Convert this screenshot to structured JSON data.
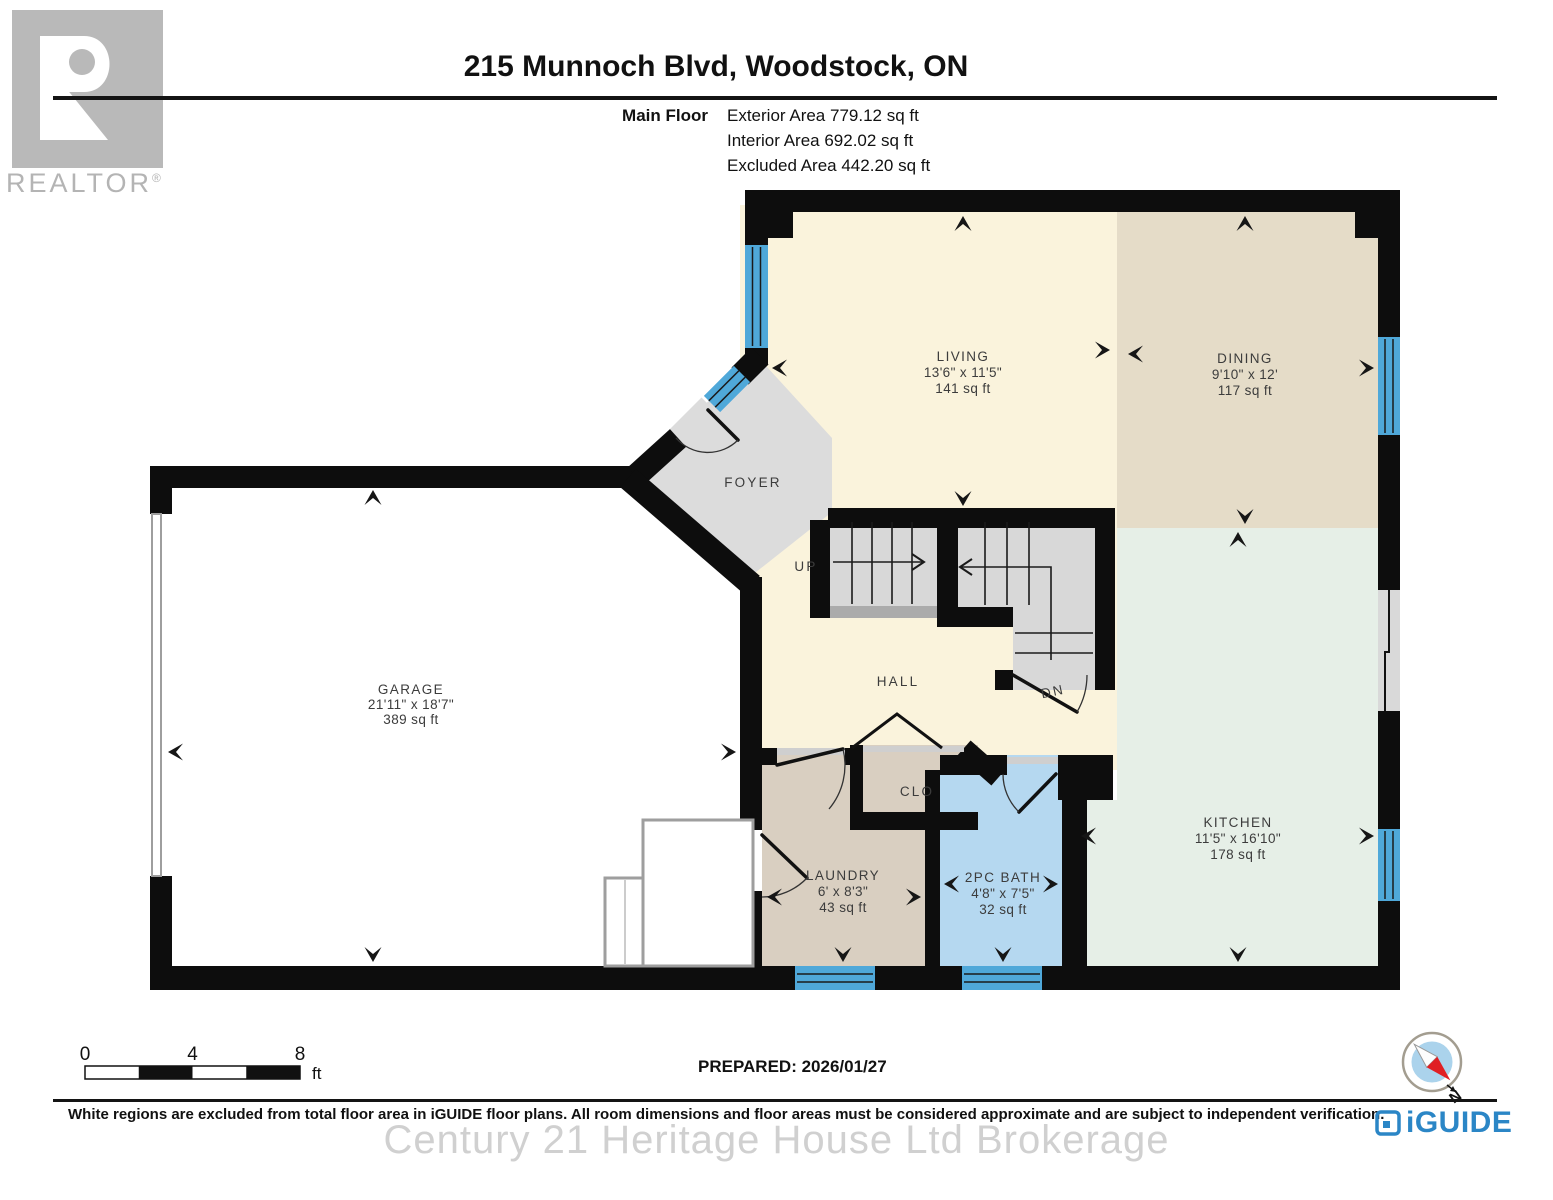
{
  "header": {
    "title": "215 Munnoch Blvd, Woodstock, ON",
    "floor_label": "Main Floor",
    "exterior_area": "Exterior Area 779.12 sq ft",
    "interior_area": "Interior Area 692.02 sq ft",
    "excluded_area": "Excluded Area 442.20 sq ft"
  },
  "branding": {
    "realtor_letter": "R",
    "realtor_wordmark": "REALTOR",
    "registered_symbol": "®",
    "iguide_wordmark": "iGUIDE",
    "watermark": "Century 21 Heritage House Ltd Brokerage"
  },
  "rooms": {
    "living": {
      "name": "LIVING",
      "dims": "13'6\" x 11'5\"",
      "area": "141 sq ft"
    },
    "dining": {
      "name": "DINING",
      "dims": "9'10\" x 12'",
      "area": "117 sq ft"
    },
    "kitchen": {
      "name": "KITCHEN",
      "dims": "11'5\" x 16'10\"",
      "area": "178 sq ft"
    },
    "garage": {
      "name": "GARAGE",
      "dims": "21'11\" x 18'7\"",
      "area": "389 sq ft"
    },
    "laundry": {
      "name": "LAUNDRY",
      "dims": "6' x 8'3\"",
      "area": "43 sq ft"
    },
    "bath": {
      "name": "2PC BATH",
      "dims": "4'8\" x 7'5\"",
      "area": "32 sq ft"
    },
    "foyer": {
      "name": "FOYER"
    },
    "hall": {
      "name": "HALL"
    },
    "closet": {
      "name": "CLO"
    },
    "stairs_up": {
      "name": "UP"
    },
    "stairs_down": {
      "name": "DN"
    }
  },
  "footer": {
    "prepared": "PREPARED: 2026/01/27",
    "disclaimer": "White regions are excluded from total floor area in iGUIDE floor plans. All room dimensions and floor areas must be considered approximate and are subject to independent verification.",
    "scale": {
      "zero": "0",
      "four": "4",
      "eight": "8",
      "unit": "ft"
    },
    "north_label": "N"
  },
  "colors": {
    "wall": "#0d0d0d",
    "floor_cream": "#faf3dc",
    "floor_tan": "#e5dcc8",
    "floor_green": "#e6efe7",
    "floor_beige": "#d9cfc1",
    "floor_blue": "#b5d8f0",
    "floor_gray": "#dcdcdc",
    "floor_white": "#ffffff",
    "stair_gray": "#d8d8d8",
    "stair_edge_gray": "#ababab",
    "window_blue": "#4fa8d9",
    "slider_gray": "#d9d9d9",
    "iguide_blue": "#2b86c6",
    "compass_red": "#e01f24",
    "compass_face": "#abd3ec"
  }
}
